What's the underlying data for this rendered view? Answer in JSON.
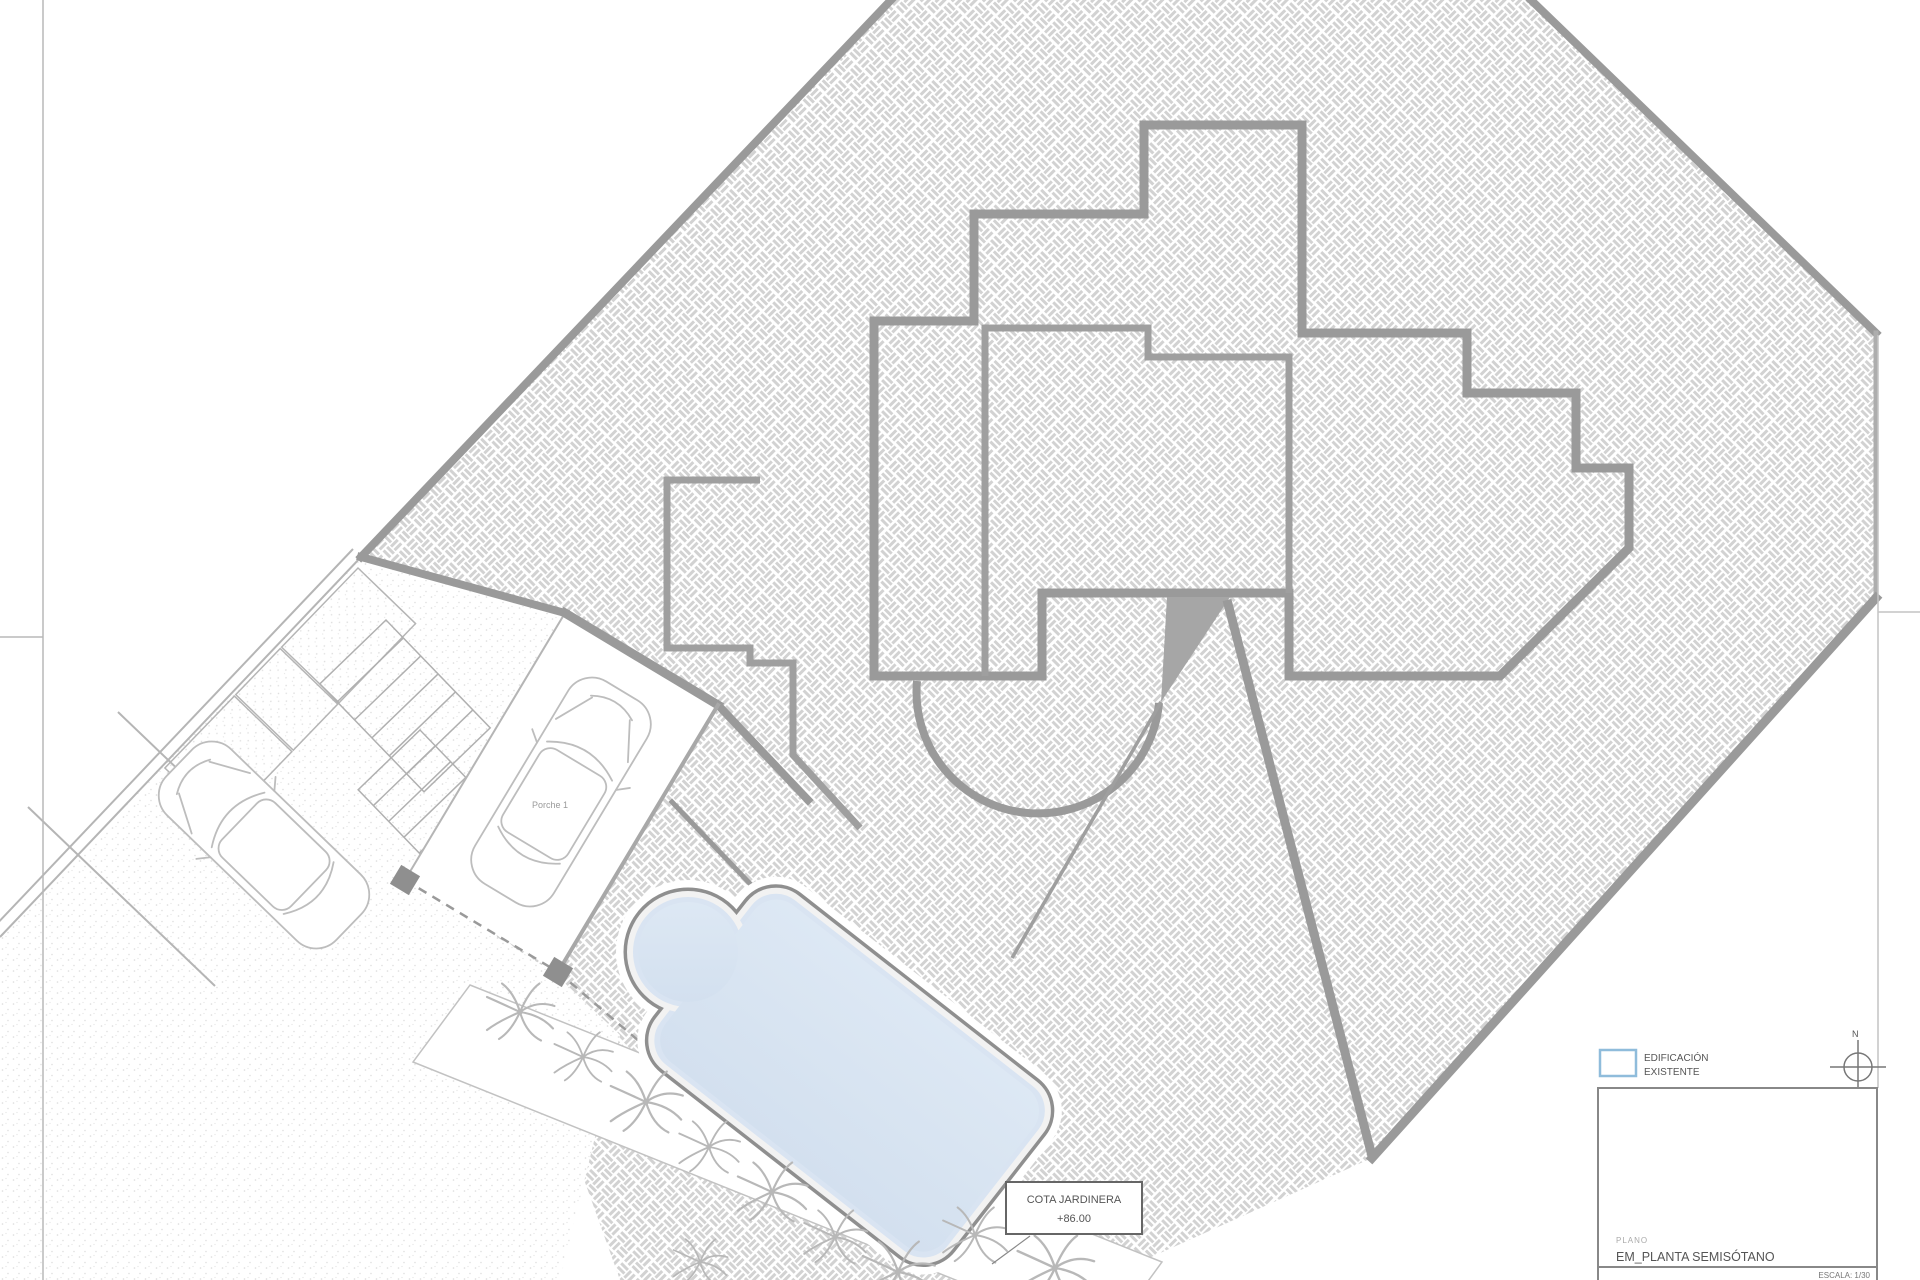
{
  "plan": {
    "porche_label": "Porche 1",
    "cota": {
      "line1": "COTA JARDINERA",
      "line2": "+86.00"
    },
    "legend": {
      "line1": "EDIFICACIÓN",
      "line2": "EXISTENTE",
      "swatch_color": "#8fbcdb"
    },
    "north_label": "N",
    "title_block": {
      "plano_label": "PLANO",
      "title": "EM_PLANTA SEMISÓTANO",
      "scale": "ESCALA: 1/30"
    },
    "colors": {
      "wall_gray": "#9a9a9a",
      "hatch_line": "#d2d2d2",
      "pool_water": "#d9e4f2",
      "pool_edge": "#8f8f8f",
      "wedge_gray": "#a6a6a6"
    }
  }
}
